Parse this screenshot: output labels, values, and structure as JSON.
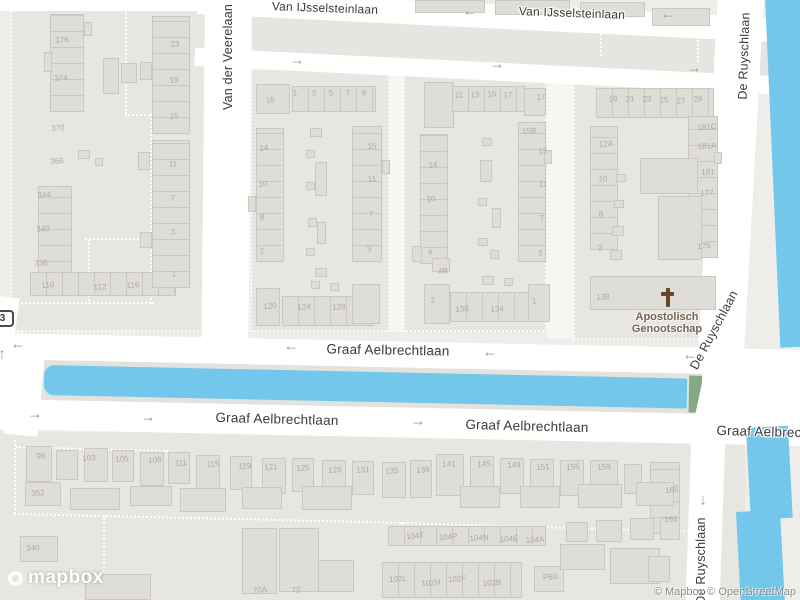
{
  "attribution": {
    "logo": "mapbox",
    "text": "© Mapbox © OpenStreetMap"
  },
  "poi": {
    "line1": "Apostolisch",
    "line2": "Genootschap",
    "icon": "christian-cross"
  },
  "shield": {
    "label": "3"
  },
  "colors": {
    "water": "#73C7EA",
    "green_bank": "#84A983",
    "road": "#FFFFFF",
    "land": "#EFEDEA",
    "block": "#E8E6E1",
    "building": "#DFDDD7",
    "street_label": "#3C3B39",
    "house_number": "#ADA9A1",
    "poi_text": "#756553",
    "poi_cross": "#6B4526",
    "attribution": "#8B8B8B"
  },
  "streets": [
    {
      "name": "Van IJsselsteinlaan",
      "x": 325,
      "y": 8,
      "rot": 2,
      "size": 12
    },
    {
      "name": "Van IJsselsteinlaan",
      "x": 572,
      "y": 13,
      "rot": 2,
      "size": 12
    },
    {
      "name": "Van der Veerelaan",
      "x": 228,
      "y": 57,
      "rot": -90,
      "size": 12.5
    },
    {
      "name": "De Ruyschlaan",
      "x": 744,
      "y": 56,
      "rot": -88,
      "size": 12.5
    },
    {
      "name": "Graaf Aelbrechtlaan",
      "x": 388,
      "y": 350,
      "rot": 1,
      "size": 13.5
    },
    {
      "name": "Graaf Aelbrechtlaan",
      "x": 277,
      "y": 419,
      "rot": 1.5,
      "size": 13.5
    },
    {
      "name": "Graaf Aelbrechtlaan",
      "x": 527,
      "y": 426,
      "rot": 1.5,
      "size": 13.5
    },
    {
      "name": "Graaf Aelbrechtlaan",
      "x": 778,
      "y": 432,
      "rot": 1.5,
      "size": 13.5
    },
    {
      "name": "De Ruyschlaan",
      "x": 714,
      "y": 330,
      "rot": -62,
      "size": 12.5
    },
    {
      "name": "De Ruyschlaan",
      "x": 701,
      "y": 561,
      "rot": -90,
      "size": 12.5
    }
  ],
  "arrows": [
    {
      "dir": "left",
      "x": 470,
      "y": 11
    },
    {
      "dir": "left",
      "x": 668,
      "y": 14
    },
    {
      "dir": "right",
      "x": 297,
      "y": 60
    },
    {
      "dir": "right",
      "x": 497,
      "y": 64
    },
    {
      "dir": "right",
      "x": 694,
      "y": 68
    },
    {
      "dir": "left",
      "x": 18,
      "y": 344
    },
    {
      "dir": "left",
      "x": 291,
      "y": 346
    },
    {
      "dir": "left",
      "x": 490,
      "y": 352
    },
    {
      "dir": "left",
      "x": 690,
      "y": 355
    },
    {
      "dir": "right",
      "x": 35,
      "y": 414
    },
    {
      "dir": "right",
      "x": 148,
      "y": 417
    },
    {
      "dir": "right",
      "x": 418,
      "y": 421
    },
    {
      "dir": "up",
      "x": 2,
      "y": 354
    },
    {
      "dir": "down",
      "x": 703,
      "y": 500
    }
  ],
  "house_numbers": [
    {
      "n": "376",
      "x": 62,
      "y": 40
    },
    {
      "n": "374",
      "x": 61,
      "y": 78
    },
    {
      "n": "370",
      "x": 58,
      "y": 128
    },
    {
      "n": "366",
      "x": 57,
      "y": 161
    },
    {
      "n": "344",
      "x": 44,
      "y": 195
    },
    {
      "n": "340",
      "x": 43,
      "y": 229
    },
    {
      "n": "336",
      "x": 41,
      "y": 263
    },
    {
      "n": "110",
      "x": 48,
      "y": 285
    },
    {
      "n": "112",
      "x": 100,
      "y": 287
    },
    {
      "n": "116",
      "x": 133,
      "y": 285
    },
    {
      "n": "23",
      "x": 175,
      "y": 44
    },
    {
      "n": "19",
      "x": 174,
      "y": 80
    },
    {
      "n": "15",
      "x": 174,
      "y": 116
    },
    {
      "n": "11",
      "x": 173,
      "y": 164
    },
    {
      "n": "7",
      "x": 173,
      "y": 198
    },
    {
      "n": "3",
      "x": 173,
      "y": 232
    },
    {
      "n": "1",
      "x": 174,
      "y": 274
    },
    {
      "n": "16",
      "x": 270,
      "y": 100
    },
    {
      "n": "1",
      "x": 295,
      "y": 93
    },
    {
      "n": "3",
      "x": 314,
      "y": 93
    },
    {
      "n": "5",
      "x": 331,
      "y": 93
    },
    {
      "n": "7",
      "x": 348,
      "y": 93
    },
    {
      "n": "9",
      "x": 364,
      "y": 93
    },
    {
      "n": "14",
      "x": 264,
      "y": 148
    },
    {
      "n": "10",
      "x": 263,
      "y": 184
    },
    {
      "n": "8",
      "x": 262,
      "y": 217
    },
    {
      "n": "2",
      "x": 262,
      "y": 251
    },
    {
      "n": "15",
      "x": 372,
      "y": 146
    },
    {
      "n": "11",
      "x": 372,
      "y": 179
    },
    {
      "n": "7",
      "x": 371,
      "y": 214
    },
    {
      "n": "3",
      "x": 369,
      "y": 249
    },
    {
      "n": "120",
      "x": 270,
      "y": 306
    },
    {
      "n": "124",
      "x": 304,
      "y": 307
    },
    {
      "n": "128",
      "x": 339,
      "y": 307
    },
    {
      "n": "11",
      "x": 459,
      "y": 95
    },
    {
      "n": "13",
      "x": 475,
      "y": 95
    },
    {
      "n": "15",
      "x": 492,
      "y": 94
    },
    {
      "n": "17",
      "x": 508,
      "y": 95
    },
    {
      "n": "17",
      "x": 541,
      "y": 97
    },
    {
      "n": "14",
      "x": 433,
      "y": 165
    },
    {
      "n": "10",
      "x": 431,
      "y": 199
    },
    {
      "n": "4",
      "x": 430,
      "y": 252
    },
    {
      "n": "4B",
      "x": 443,
      "y": 271
    },
    {
      "n": "15B",
      "x": 529,
      "y": 131
    },
    {
      "n": "15",
      "x": 543,
      "y": 151
    },
    {
      "n": "11",
      "x": 543,
      "y": 184
    },
    {
      "n": "7",
      "x": 542,
      "y": 218
    },
    {
      "n": "3",
      "x": 540,
      "y": 253
    },
    {
      "n": "2",
      "x": 433,
      "y": 300
    },
    {
      "n": "130",
      "x": 462,
      "y": 309
    },
    {
      "n": "134",
      "x": 497,
      "y": 309
    },
    {
      "n": "1",
      "x": 534,
      "y": 301
    },
    {
      "n": "19",
      "x": 613,
      "y": 99
    },
    {
      "n": "21",
      "x": 630,
      "y": 99
    },
    {
      "n": "23",
      "x": 647,
      "y": 99
    },
    {
      "n": "25",
      "x": 664,
      "y": 100
    },
    {
      "n": "27",
      "x": 681,
      "y": 101
    },
    {
      "n": "29",
      "x": 698,
      "y": 99
    },
    {
      "n": "12A",
      "x": 606,
      "y": 144
    },
    {
      "n": "10",
      "x": 603,
      "y": 179
    },
    {
      "n": "8",
      "x": 601,
      "y": 214
    },
    {
      "n": "2",
      "x": 600,
      "y": 248
    },
    {
      "n": "181C",
      "x": 707,
      "y": 127
    },
    {
      "n": "181A",
      "x": 707,
      "y": 146
    },
    {
      "n": "181",
      "x": 708,
      "y": 172
    },
    {
      "n": "177",
      "x": 707,
      "y": 193
    },
    {
      "n": "175",
      "x": 704,
      "y": 246
    },
    {
      "n": "138",
      "x": 603,
      "y": 297
    },
    {
      "n": "99",
      "x": 41,
      "y": 456
    },
    {
      "n": "103",
      "x": 89,
      "y": 458
    },
    {
      "n": "105",
      "x": 122,
      "y": 459
    },
    {
      "n": "109",
      "x": 155,
      "y": 460
    },
    {
      "n": "111",
      "x": 181,
      "y": 463
    },
    {
      "n": "115",
      "x": 213,
      "y": 464
    },
    {
      "n": "119",
      "x": 245,
      "y": 466
    },
    {
      "n": "121",
      "x": 271,
      "y": 467
    },
    {
      "n": "125",
      "x": 303,
      "y": 468
    },
    {
      "n": "129",
      "x": 335,
      "y": 470
    },
    {
      "n": "131",
      "x": 363,
      "y": 470
    },
    {
      "n": "135",
      "x": 392,
      "y": 471
    },
    {
      "n": "139",
      "x": 423,
      "y": 470
    },
    {
      "n": "141",
      "x": 449,
      "y": 464
    },
    {
      "n": "145",
      "x": 484,
      "y": 464
    },
    {
      "n": "149",
      "x": 514,
      "y": 465
    },
    {
      "n": "151",
      "x": 543,
      "y": 467
    },
    {
      "n": "155",
      "x": 573,
      "y": 467
    },
    {
      "n": "159",
      "x": 604,
      "y": 467
    },
    {
      "n": "165",
      "x": 672,
      "y": 490
    },
    {
      "n": "161",
      "x": 671,
      "y": 519
    },
    {
      "n": "352",
      "x": 38,
      "y": 493
    },
    {
      "n": "340",
      "x": 33,
      "y": 548
    },
    {
      "n": "70A",
      "x": 260,
      "y": 590
    },
    {
      "n": "72",
      "x": 296,
      "y": 590
    },
    {
      "n": "104T",
      "x": 415,
      "y": 536
    },
    {
      "n": "104P",
      "x": 448,
      "y": 537
    },
    {
      "n": "104N",
      "x": 479,
      "y": 538
    },
    {
      "n": "104E",
      "x": 509,
      "y": 539
    },
    {
      "n": "104A",
      "x": 535,
      "y": 540
    },
    {
      "n": "102L",
      "x": 398,
      "y": 579
    },
    {
      "n": "102H",
      "x": 431,
      "y": 583
    },
    {
      "n": "102F",
      "x": 457,
      "y": 579
    },
    {
      "n": "102B",
      "x": 492,
      "y": 583
    },
    {
      "n": "P60",
      "x": 550,
      "y": 577
    }
  ]
}
